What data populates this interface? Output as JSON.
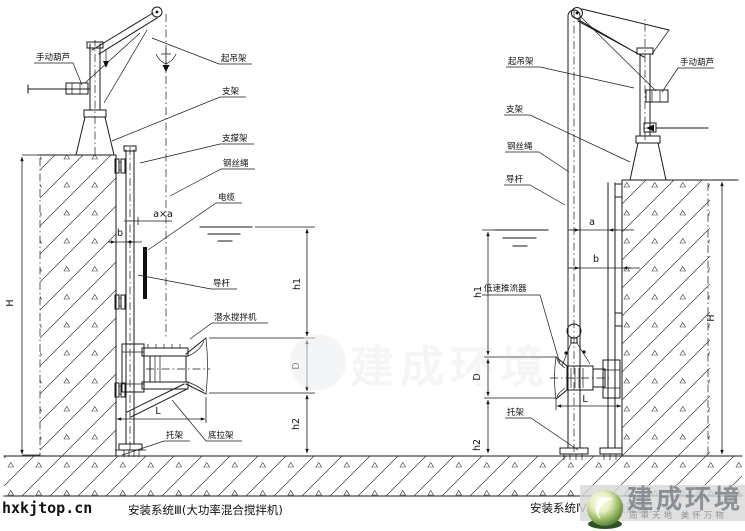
{
  "site": {
    "url": "hxkjtop.cn"
  },
  "left_diagram": {
    "caption": "安装系统Ⅲ(大功率混合搅拌机)",
    "labels": {
      "hand_hoist": "手动葫芦",
      "lifting_frame": "起吊架",
      "support": "支架",
      "support_frame": "支撑架",
      "wire_rope": "钢丝绳",
      "cable": "电缆",
      "guide_rod": "导杆",
      "submersible_mixer": "潜水搅拌机",
      "bracket": "托架",
      "bottom_tie_frame": "底拉架"
    },
    "dimensions": {
      "overall_height": "H",
      "water_depth": "h1",
      "propeller_diameter": "D",
      "bottom_clearance": "h2",
      "reach": "L",
      "wall_offset": "b",
      "pole_section": "a×a"
    }
  },
  "right_diagram": {
    "caption": "安装系统Ⅳ(低速推流器)",
    "labels": {
      "lifting_frame": "起吊架",
      "hand_hoist": "手动葫芦",
      "support": "支架",
      "wire_rope": "钢丝绳",
      "guide_rod": "导杆",
      "low_speed_propeller": "低速推流器",
      "bracket": "托架"
    },
    "dimensions": {
      "overall_height": "H",
      "water_depth": "h1",
      "propeller_diameter": "D",
      "bottom_clearance": "h2",
      "reach": "L",
      "gap_a": "a",
      "gap_b": "b"
    }
  },
  "watermark": {
    "brand": "建成环境",
    "tagline": "周审天地 美怀万物"
  },
  "colors": {
    "line": "#1a1a1a",
    "background": "#ffffff",
    "watermark_gray": "#8a9096",
    "logo_green": "#5c8f3e"
  }
}
